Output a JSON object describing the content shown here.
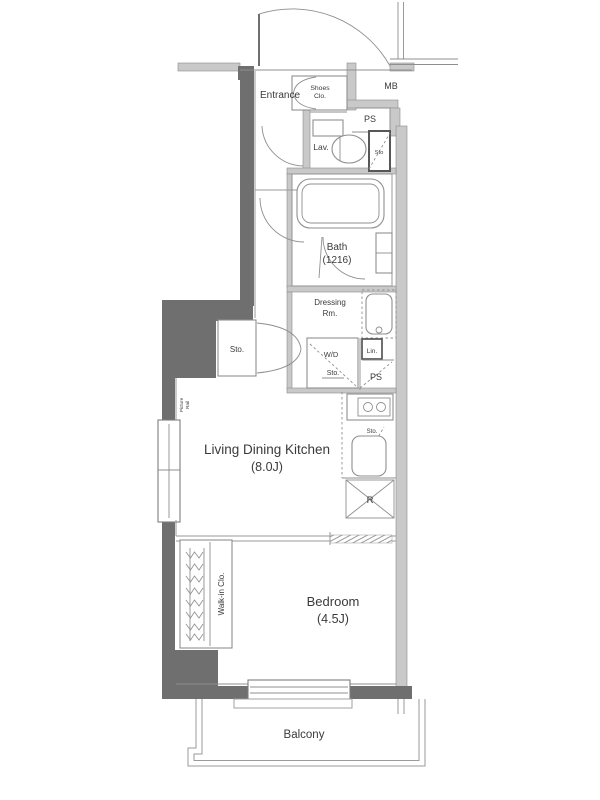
{
  "plan_title": "1K apartment floor plan",
  "colors": {
    "wall_dark": "#6f6f6f",
    "wall_light": "#c9c9c9",
    "wall_edge": "#8d8d8d",
    "line": "#9a9a9a",
    "fixture": "#8f8f8f",
    "text": "#3a3a3a",
    "background": "#ffffff"
  },
  "rooms": {
    "entrance": {
      "label": "Entrance"
    },
    "shoes_closet": {
      "line1": "Shoes",
      "line2": "Clo."
    },
    "meter_box": {
      "label": "MB"
    },
    "pipe_space_upper": {
      "label": "PS"
    },
    "lavatory": {
      "label": "Lav."
    },
    "toilet_storage": {
      "label": "Sto"
    },
    "bath": {
      "name": "Bath",
      "size": "(1216)"
    },
    "dressing_room": {
      "line1": "Dressing",
      "line2": "Rm."
    },
    "washer_dryer": {
      "label": "W/D",
      "storage": "Sto."
    },
    "linen": {
      "label": "Lin."
    },
    "pipe_space_lower": {
      "label": "PS"
    },
    "hall_storage": {
      "label": "Sto."
    },
    "kitchen_storage": {
      "label": "Sto."
    },
    "refrigerator": {
      "label": "R"
    },
    "living": {
      "name": "Living Dining Kitchen",
      "size": "(8.0J)"
    },
    "bedroom": {
      "name": "Bedroom",
      "size": "(4.5J)"
    },
    "walk_in_closet": {
      "label": "Walk-in Clo."
    },
    "balcony": {
      "label": "Balcony"
    },
    "picture_rail": {
      "line1": "Picture",
      "line2": "Rail"
    }
  }
}
